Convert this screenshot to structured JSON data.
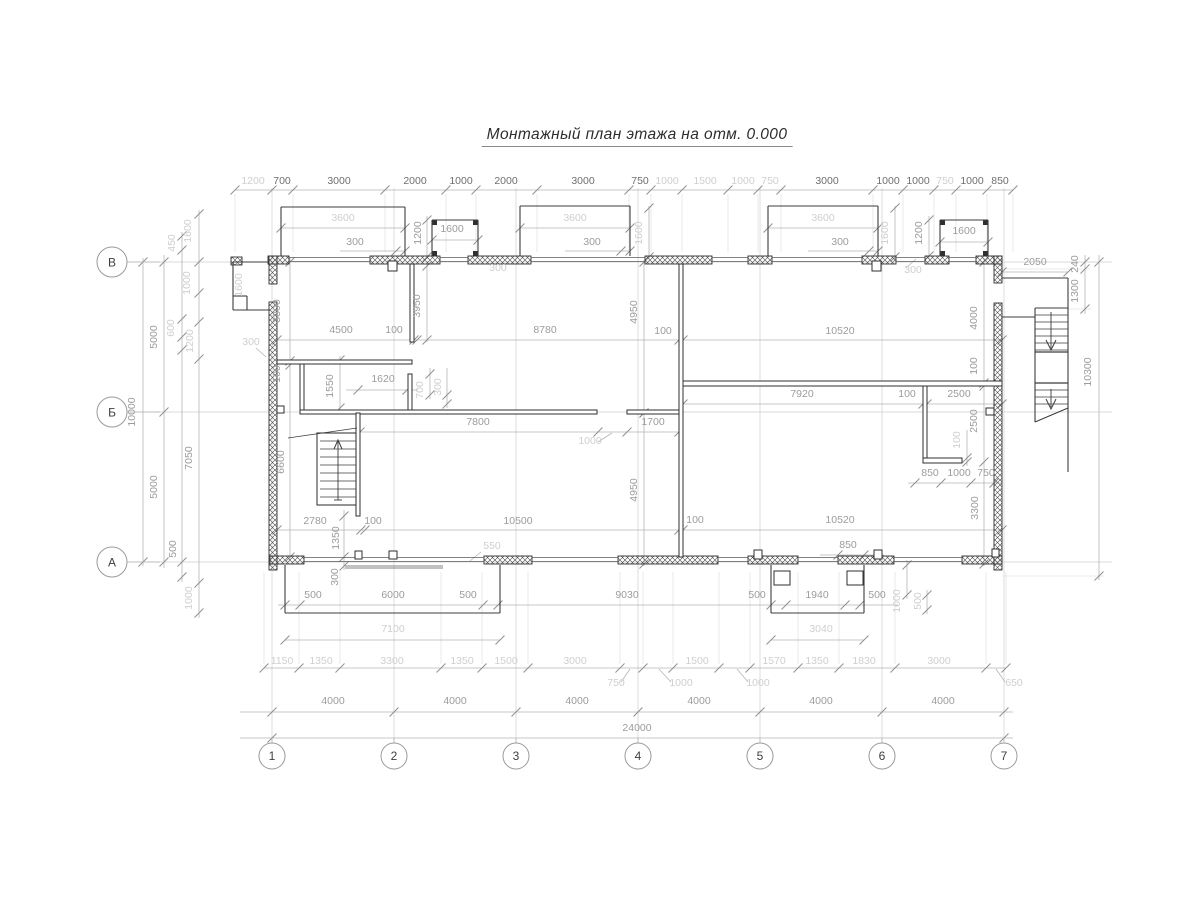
{
  "title": "Монтажный план этажа на отм. 0.000",
  "colors": {
    "wall": "#2f2f2f",
    "hatch": "#4a4a4a",
    "dim_line": "#b5b5b5",
    "tick": "#8f8f8f",
    "grid": "#d9d9d9",
    "witness": "#e4e4e4",
    "text_dark": "#6f6f6f",
    "text_medium": "#9c9c9c",
    "text_light": "#cfcfcf"
  },
  "axes": {
    "bottom": [
      {
        "label": "1",
        "x": 272
      },
      {
        "label": "2",
        "x": 394
      },
      {
        "label": "3",
        "x": 516
      },
      {
        "label": "4",
        "x": 638
      },
      {
        "label": "5",
        "x": 760
      },
      {
        "label": "6",
        "x": 882
      },
      {
        "label": "7",
        "x": 1004
      }
    ],
    "bottom_circle_y": 756,
    "left": [
      {
        "label": "В",
        "y": 262
      },
      {
        "label": "Б",
        "y": 412
      },
      {
        "label": "А",
        "y": 562
      }
    ],
    "left_circle_x": 112
  },
  "dim_labels": [
    {
      "t": "1200",
      "x": 253,
      "y": 184,
      "r": 0,
      "s": "l"
    },
    {
      "t": "700",
      "x": 282,
      "y": 184,
      "r": 0,
      "s": "d"
    },
    {
      "t": "3000",
      "x": 339,
      "y": 184,
      "r": 0,
      "s": "d"
    },
    {
      "t": "2000",
      "x": 415,
      "y": 184,
      "r": 0,
      "s": "d"
    },
    {
      "t": "1000",
      "x": 461,
      "y": 184,
      "r": 0,
      "s": "d"
    },
    {
      "t": "2000",
      "x": 506,
      "y": 184,
      "r": 0,
      "s": "d"
    },
    {
      "t": "3000",
      "x": 583,
      "y": 184,
      "r": 0,
      "s": "d"
    },
    {
      "t": "750",
      "x": 640,
      "y": 184,
      "r": 0,
      "s": "d"
    },
    {
      "t": "1000",
      "x": 667,
      "y": 184,
      "r": 0,
      "s": "l"
    },
    {
      "t": "1500",
      "x": 705,
      "y": 184,
      "r": 0,
      "s": "l"
    },
    {
      "t": "1000",
      "x": 743,
      "y": 184,
      "r": 0,
      "s": "l"
    },
    {
      "t": "750",
      "x": 770,
      "y": 184,
      "r": 0,
      "s": "l"
    },
    {
      "t": "3000",
      "x": 827,
      "y": 184,
      "r": 0,
      "s": "d"
    },
    {
      "t": "1000",
      "x": 888,
      "y": 184,
      "r": 0,
      "s": "d"
    },
    {
      "t": "1000",
      "x": 918,
      "y": 184,
      "r": 0,
      "s": "d"
    },
    {
      "t": "750",
      "x": 945,
      "y": 184,
      "r": 0,
      "s": "l"
    },
    {
      "t": "1000",
      "x": 972,
      "y": 184,
      "r": 0,
      "s": "d"
    },
    {
      "t": "850",
      "x": 1000,
      "y": 184,
      "r": 0,
      "s": "d"
    },
    {
      "t": "3600",
      "x": 343,
      "y": 221,
      "r": 0,
      "s": "l"
    },
    {
      "t": "3600",
      "x": 575,
      "y": 221,
      "r": 0,
      "s": "l"
    },
    {
      "t": "3600",
      "x": 823,
      "y": 221,
      "r": 0,
      "s": "l"
    },
    {
      "t": "300",
      "x": 355,
      "y": 245,
      "r": 0,
      "s": "m"
    },
    {
      "t": "300",
      "x": 592,
      "y": 245,
      "r": 0,
      "s": "m"
    },
    {
      "t": "300",
      "x": 840,
      "y": 245,
      "r": 0,
      "s": "m"
    },
    {
      "t": "1200",
      "x": 421,
      "y": 233,
      "r": -90,
      "s": "m"
    },
    {
      "t": "1600",
      "x": 452,
      "y": 232,
      "r": 0,
      "s": "m"
    },
    {
      "t": "300",
      "x": 498,
      "y": 271,
      "r": 0,
      "s": "l"
    },
    {
      "t": "1600",
      "x": 642,
      "y": 233,
      "r": -90,
      "s": "l"
    },
    {
      "t": "1600",
      "x": 888,
      "y": 233,
      "r": -90,
      "s": "l"
    },
    {
      "t": "1200",
      "x": 922,
      "y": 233,
      "r": -90,
      "s": "m"
    },
    {
      "t": "1600",
      "x": 964,
      "y": 234,
      "r": 0,
      "s": "m"
    },
    {
      "t": "300",
      "x": 913,
      "y": 273,
      "r": 0,
      "s": "l"
    },
    {
      "t": "2050",
      "x": 1035,
      "y": 265,
      "r": 0,
      "s": "m"
    },
    {
      "t": "240",
      "x": 1078,
      "y": 264,
      "r": -90,
      "s": "m"
    },
    {
      "t": "1300",
      "x": 1078,
      "y": 291,
      "r": -90,
      "s": "m"
    },
    {
      "t": "450",
      "x": 175,
      "y": 243,
      "r": -90,
      "s": "l"
    },
    {
      "t": "1600",
      "x": 191,
      "y": 231,
      "r": -90,
      "s": "l"
    },
    {
      "t": "1000",
      "x": 190,
      "y": 283,
      "r": -90,
      "s": "l"
    },
    {
      "t": "600",
      "x": 174,
      "y": 328,
      "r": -90,
      "s": "l"
    },
    {
      "t": "1200",
      "x": 193,
      "y": 341,
      "r": -90,
      "s": "l"
    },
    {
      "t": "5000",
      "x": 157,
      "y": 337,
      "r": -90,
      "s": "m"
    },
    {
      "t": "10000",
      "x": 135,
      "y": 412,
      "r": -90,
      "s": "m"
    },
    {
      "t": "5000",
      "x": 157,
      "y": 487,
      "r": -90,
      "s": "m"
    },
    {
      "t": "7050",
      "x": 192,
      "y": 458,
      "r": -90,
      "s": "m"
    },
    {
      "t": "500",
      "x": 176,
      "y": 549,
      "r": -90,
      "s": "m"
    },
    {
      "t": "1000",
      "x": 192,
      "y": 598,
      "r": -90,
      "s": "l"
    },
    {
      "t": "1600",
      "x": 242,
      "y": 285,
      "r": -90,
      "s": "l"
    },
    {
      "t": "3300",
      "x": 280,
      "y": 311,
      "r": -90,
      "s": "m"
    },
    {
      "t": "300",
      "x": 251,
      "y": 345,
      "r": 0,
      "s": "l"
    },
    {
      "t": "100",
      "x": 280,
      "y": 374,
      "r": -90,
      "s": "m"
    },
    {
      "t": "6600",
      "x": 284,
      "y": 462,
      "r": -90,
      "s": "m"
    },
    {
      "t": "3950",
      "x": 420,
      "y": 306,
      "r": -90,
      "s": "m"
    },
    {
      "t": "4500",
      "x": 341,
      "y": 333,
      "r": 0,
      "s": "m"
    },
    {
      "t": "100",
      "x": 394,
      "y": 333,
      "r": 0,
      "s": "m"
    },
    {
      "t": "8780",
      "x": 545,
      "y": 333,
      "r": 0,
      "s": "m"
    },
    {
      "t": "4950",
      "x": 637,
      "y": 312,
      "r": -90,
      "s": "m"
    },
    {
      "t": "100",
      "x": 663,
      "y": 334,
      "r": 0,
      "s": "m"
    },
    {
      "t": "10520",
      "x": 840,
      "y": 334,
      "r": 0,
      "s": "m"
    },
    {
      "t": "4000",
      "x": 977,
      "y": 318,
      "r": -90,
      "s": "m"
    },
    {
      "t": "100",
      "x": 977,
      "y": 366,
      "r": -90,
      "s": "m"
    },
    {
      "t": "1550",
      "x": 333,
      "y": 386,
      "r": -90,
      "s": "m"
    },
    {
      "t": "1620",
      "x": 383,
      "y": 382,
      "r": 0,
      "s": "m"
    },
    {
      "t": "700",
      "x": 423,
      "y": 390,
      "r": -90,
      "s": "l"
    },
    {
      "t": "300",
      "x": 441,
      "y": 387,
      "r": -90,
      "s": "l"
    },
    {
      "t": "7800",
      "x": 478,
      "y": 425,
      "r": 0,
      "s": "m"
    },
    {
      "t": "1000",
      "x": 590,
      "y": 444,
      "r": 0,
      "s": "l"
    },
    {
      "t": "1700",
      "x": 653,
      "y": 425,
      "r": 0,
      "s": "m"
    },
    {
      "t": "7920",
      "x": 802,
      "y": 397,
      "r": 0,
      "s": "m"
    },
    {
      "t": "100",
      "x": 907,
      "y": 397,
      "r": 0,
      "s": "m"
    },
    {
      "t": "2500",
      "x": 959,
      "y": 397,
      "r": 0,
      "s": "m"
    },
    {
      "t": "2500",
      "x": 977,
      "y": 421,
      "r": -90,
      "s": "m"
    },
    {
      "t": "100",
      "x": 960,
      "y": 440,
      "r": -90,
      "s": "l"
    },
    {
      "t": "850",
      "x": 930,
      "y": 476,
      "r": 0,
      "s": "m"
    },
    {
      "t": "1000",
      "x": 959,
      "y": 476,
      "r": 0,
      "s": "m"
    },
    {
      "t": "750",
      "x": 986,
      "y": 476,
      "r": 0,
      "s": "m"
    },
    {
      "t": "10300",
      "x": 1091,
      "y": 372,
      "r": -90,
      "s": "m"
    },
    {
      "t": "2780",
      "x": 315,
      "y": 524,
      "r": 0,
      "s": "m"
    },
    {
      "t": "100",
      "x": 373,
      "y": 524,
      "r": 0,
      "s": "m"
    },
    {
      "t": "10500",
      "x": 518,
      "y": 524,
      "r": 0,
      "s": "m"
    },
    {
      "t": "4950",
      "x": 637,
      "y": 490,
      "r": -90,
      "s": "m"
    },
    {
      "t": "100",
      "x": 695,
      "y": 523,
      "r": 0,
      "s": "m"
    },
    {
      "t": "10520",
      "x": 840,
      "y": 523,
      "r": 0,
      "s": "m"
    },
    {
      "t": "1350",
      "x": 339,
      "y": 538,
      "r": -90,
      "s": "m"
    },
    {
      "t": "300",
      "x": 338,
      "y": 577,
      "r": -90,
      "s": "m"
    },
    {
      "t": "550",
      "x": 492,
      "y": 549,
      "r": 0,
      "s": "l"
    },
    {
      "t": "850",
      "x": 848,
      "y": 548,
      "r": 0,
      "s": "m"
    },
    {
      "t": "3300",
      "x": 978,
      "y": 508,
      "r": -90,
      "s": "m"
    },
    {
      "t": "500",
      "x": 313,
      "y": 598,
      "r": 0,
      "s": "m"
    },
    {
      "t": "6000",
      "x": 393,
      "y": 598,
      "r": 0,
      "s": "m"
    },
    {
      "t": "500",
      "x": 468,
      "y": 598,
      "r": 0,
      "s": "m"
    },
    {
      "t": "9030",
      "x": 627,
      "y": 598,
      "r": 0,
      "s": "m"
    },
    {
      "t": "7100",
      "x": 393,
      "y": 632,
      "r": 0,
      "s": "l"
    },
    {
      "t": "500",
      "x": 757,
      "y": 598,
      "r": 0,
      "s": "m"
    },
    {
      "t": "1940",
      "x": 817,
      "y": 598,
      "r": 0,
      "s": "m"
    },
    {
      "t": "500",
      "x": 877,
      "y": 598,
      "r": 0,
      "s": "m"
    },
    {
      "t": "3040",
      "x": 821,
      "y": 632,
      "r": 0,
      "s": "l"
    },
    {
      "t": "1000",
      "x": 900,
      "y": 601,
      "r": -90,
      "s": "l"
    },
    {
      "t": "500",
      "x": 921,
      "y": 601,
      "r": -90,
      "s": "l"
    },
    {
      "t": "1150",
      "x": 282,
      "y": 664,
      "r": 0,
      "s": "l"
    },
    {
      "t": "1350",
      "x": 321,
      "y": 664,
      "r": 0,
      "s": "l"
    },
    {
      "t": "3300",
      "x": 392,
      "y": 664,
      "r": 0,
      "s": "l"
    },
    {
      "t": "1350",
      "x": 462,
      "y": 664,
      "r": 0,
      "s": "l"
    },
    {
      "t": "1500",
      "x": 506,
      "y": 664,
      "r": 0,
      "s": "l"
    },
    {
      "t": "3000",
      "x": 575,
      "y": 664,
      "r": 0,
      "s": "l"
    },
    {
      "t": "750",
      "x": 616,
      "y": 686,
      "r": 0,
      "s": "l"
    },
    {
      "t": "1000",
      "x": 681,
      "y": 686,
      "r": 0,
      "s": "l"
    },
    {
      "t": "1500",
      "x": 697,
      "y": 664,
      "r": 0,
      "s": "l"
    },
    {
      "t": "1000",
      "x": 758,
      "y": 686,
      "r": 0,
      "s": "l"
    },
    {
      "t": "1570",
      "x": 774,
      "y": 664,
      "r": 0,
      "s": "l"
    },
    {
      "t": "1350",
      "x": 817,
      "y": 664,
      "r": 0,
      "s": "l"
    },
    {
      "t": "1830",
      "x": 864,
      "y": 664,
      "r": 0,
      "s": "l"
    },
    {
      "t": "3000",
      "x": 939,
      "y": 664,
      "r": 0,
      "s": "l"
    },
    {
      "t": "650",
      "x": 1014,
      "y": 686,
      "r": 0,
      "s": "l"
    },
    {
      "t": "4000",
      "x": 333,
      "y": 704,
      "r": 0,
      "s": "m"
    },
    {
      "t": "4000",
      "x": 455,
      "y": 704,
      "r": 0,
      "s": "m"
    },
    {
      "t": "4000",
      "x": 577,
      "y": 704,
      "r": 0,
      "s": "m"
    },
    {
      "t": "4000",
      "x": 699,
      "y": 704,
      "r": 0,
      "s": "m"
    },
    {
      "t": "4000",
      "x": 821,
      "y": 704,
      "r": 0,
      "s": "m"
    },
    {
      "t": "4000",
      "x": 943,
      "y": 704,
      "r": 0,
      "s": "m"
    },
    {
      "t": "24000",
      "x": 637,
      "y": 731,
      "r": 0,
      "s": "m"
    }
  ]
}
